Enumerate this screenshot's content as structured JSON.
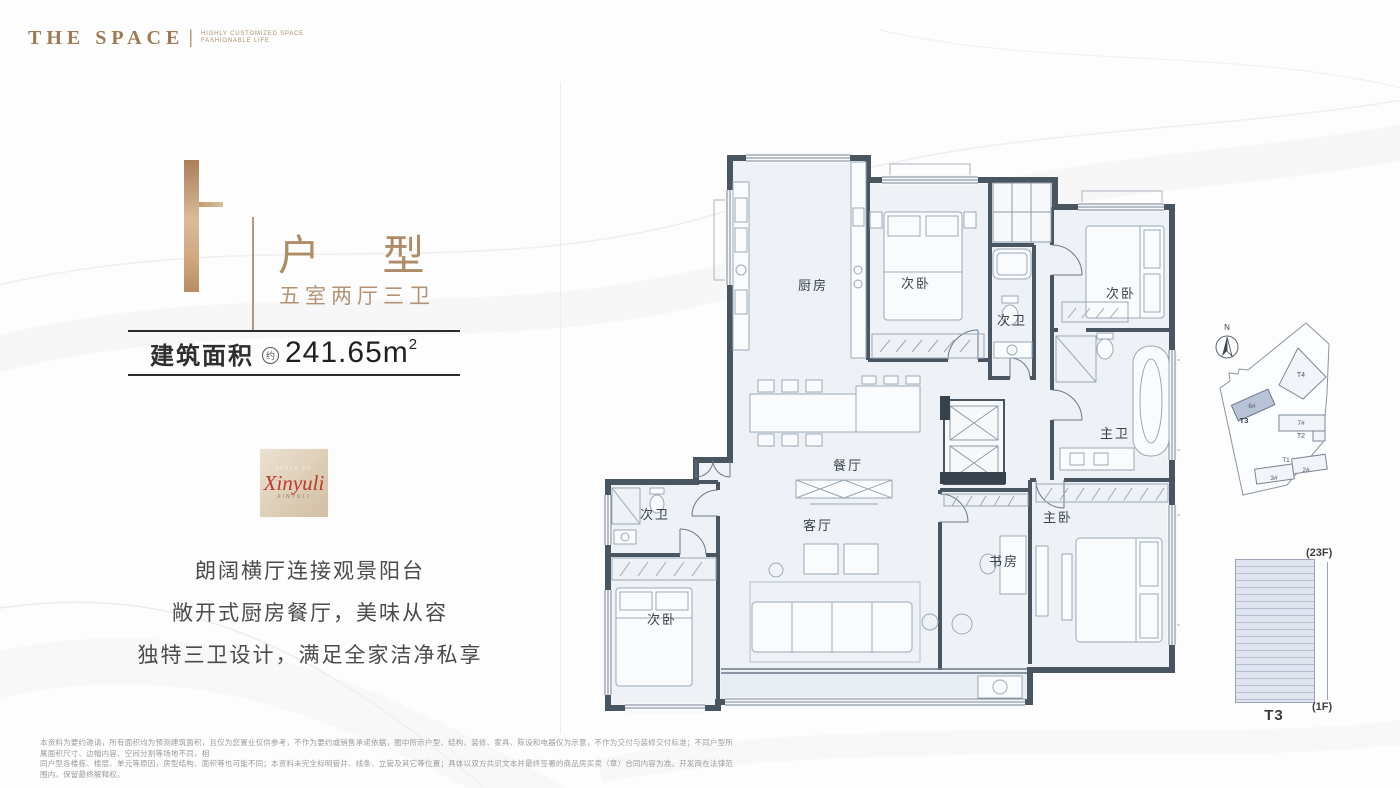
{
  "brand": {
    "name": "THE SPACE",
    "separator": "|",
    "tagline1": "HIGHLY CUSTOMIZED SPACE",
    "tagline2": "FASHIONABLE LIFE"
  },
  "unit": {
    "letter": "F",
    "type": "户 型",
    "layout": "五室两厅三卫"
  },
  "area": {
    "label": "建筑面积",
    "approx": "约",
    "value": "241.65m",
    "sup": "2"
  },
  "seal": {
    "top": "SPACE OF",
    "script": "Xinyuli",
    "bottom": "XINYULI"
  },
  "features": {
    "line1": "朗阔横厅连接观景阳台",
    "line2": "敞开式厨房餐厅，美味从容",
    "line3": "独特三卫设计，满足全家洁净私享"
  },
  "rooms": {
    "kitchen": "厨房",
    "bedroom_top": "次卧",
    "bath_top": "次卫",
    "bedroom_right": "次卧",
    "master_bath": "主卫",
    "master_bedroom": "主卧",
    "dining": "餐厅",
    "living": "客厅",
    "study": "书房",
    "bath_left": "次卫",
    "bedroom_left": "次卧"
  },
  "sitemap": {
    "north": "N",
    "t4": "T4",
    "t3_unit": "6#",
    "t3": "T3",
    "t2_unit": "7#",
    "t2": "T2",
    "t1": "T1",
    "b3": "3#",
    "b2": "2#"
  },
  "tower": {
    "label": "T3",
    "top": "(23F)",
    "bottom": "(1F)"
  },
  "disclaimer": {
    "line1": "本资料为要约邀请，所有面积均为预测建筑面积，且仅为您置业仅供参考，不作为要约或销售承诺依据，图中所示户型、结构、装修、家具、陈设和电器仅为示意，不作为交付与装修交付标准；不同户型所属面积尺寸、边幅内容、空间分割等场地不同，相",
    "line2": "同户型各楼栋、楼层、单元等原因，房型结构、面积等也可能不同；本资料未完全标明管井、线条、立管及其它等位置；具体以双方共识文本并最终签署的商品房买卖（章）合同内容为准。开发商在法律范围内，保留最终解释权。"
  },
  "colors": {
    "bronze": "#ae8c68",
    "wall": "#4a5562",
    "floor": "#eef2f6",
    "seal_red": "#bc392c",
    "t3_fill": "#b9c3d8"
  }
}
